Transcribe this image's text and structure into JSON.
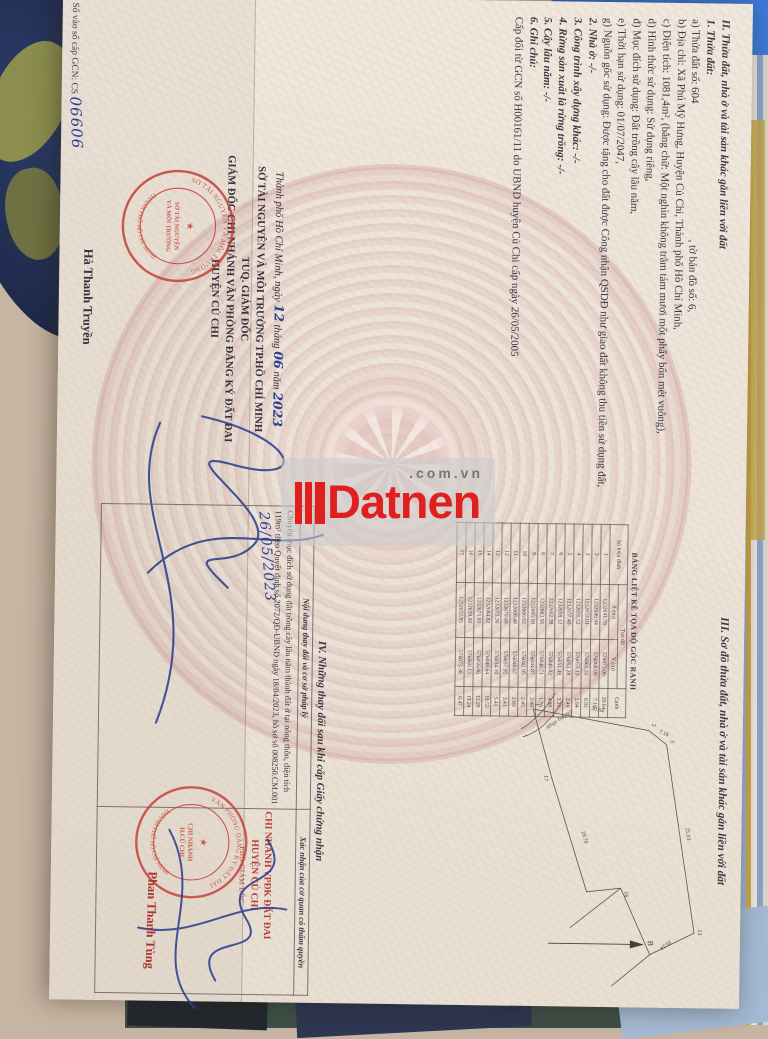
{
  "watermark": {
    "brand": "Datnen",
    "suffix": ".com.vn"
  },
  "page_left": {
    "section2": {
      "lines": [
        {
          "t": "II. Thửa đất, nhà ở và tài sản khác gắn liền với đất",
          "c": "hd"
        },
        {
          "t": "1. Thửa đất:",
          "c": "hd"
        },
        {
          "t": "a) Thửa đất số: 604                                                  , tờ bản đồ số: 6,",
          "c": ""
        },
        {
          "t": "b) Địa chỉ: Xã Phú Mỹ Hưng, Huyện Củ Chi, Thành phố Hồ Chí Minh,",
          "c": ""
        },
        {
          "t": "c) Diện tích: 1081,4m², (bằng chữ: Một nghìn không trăm tám mươi mốt phẩy bốn mét vuông),",
          "c": ""
        },
        {
          "t": "d) Hình thức sử dụng: Sử dụng riêng,",
          "c": ""
        },
        {
          "t": "đ) Mục đích sử dụng: Đất trồng cây lâu năm,",
          "c": ""
        },
        {
          "t": "e) Thời hạn sử dụng: 01/07/2047,",
          "c": ""
        },
        {
          "t": "g) Nguồn gốc sử dụng: Được tặng cho đất được Công nhận QSDĐ như giao đất không thu tiền sử dụng đất,",
          "c": ""
        },
        {
          "t": "2. Nhà ở: -/-",
          "c": "hd"
        },
        {
          "t": "3. Công trình xây dựng khác: -/-",
          "c": "hd"
        },
        {
          "t": "4. Rừng sản xuất là rừng trồng: -/-",
          "c": "hd"
        },
        {
          "t": "5. Cây lâu năm: -/-",
          "c": "hd"
        },
        {
          "t": "6. Ghi chú:",
          "c": "hd"
        },
        {
          "t": "Cấp đổi từ GCN số H00161/11 do UBND huyện Củ Chi cấp ngày 26/05/2005",
          "c": ""
        }
      ]
    },
    "book_no": {
      "label": "Số vào sổ cấp GCN: CS ",
      "value": "06606"
    },
    "sign_block": {
      "place": "Thành phố Hồ Chí Minh, ngày",
      "day": "12",
      "thang": "tháng",
      "month": "06",
      "nam": "năm",
      "year": "2023",
      "org": "SỞ TÀI NGUYÊN VÀ MÔI TRƯỜNG TP.HỒ CHÍ MINH",
      "tuq": "TUQ. GIÁM ĐỐC",
      "director": "GIÁM ĐỐC CHI NHÁNH VĂN PHÒNG ĐĂNG KÝ ĐẤT ĐAI",
      "district": "HUYỆN CỦ CHI",
      "signer": "Hà Thanh Truyền"
    },
    "stamp": {
      "arc_top": "SỞ TÀI NGUYÊN VÀ MÔI TRƯỜNG",
      "arc_bottom": "THÀNH PHỐ HỒ CHÍ MINH",
      "center1": "SỞ TÀI NGUYÊN",
      "center2": "VÀ MÔI TRƯỜNG",
      "star": "★"
    }
  },
  "page_right": {
    "section3_title": "III. Sơ đồ thửa đất, nhà ở và tài sản khác gắn liền với đất",
    "coord_table": {
      "title": "BẢNG LIỆT KÊ TỌA ĐỘ GÓC RANH",
      "col_point": "Số hiệu đỉnh",
      "col_coord": "Tọa độ",
      "col_x": "X (m)",
      "col_y": "Y (m)",
      "col_edge": "Cạnh",
      "rows": [
        [
          "1",
          "1232641.76",
          "576073.00",
          "20.64"
        ],
        [
          "2",
          "1232649.94",
          "576068.09",
          "7.16"
        ],
        [
          "3",
          "1232653.01",
          "576061.31",
          "6.92"
        ],
        [
          "4",
          "1232655.52",
          "576055.13",
          "2.64"
        ],
        [
          "5",
          "1232657.40",
          "576053.28",
          "2.49"
        ],
        [
          "6",
          "1232659.12",
          "576051.49",
          "2.31"
        ],
        [
          "7",
          "1232662.38",
          "576048.02",
          "4.90"
        ],
        [
          "8",
          "1232663.56",
          "576046.71",
          "1.76"
        ],
        [
          "9",
          "1232665.10",
          "576044.87",
          "2.40"
        ],
        [
          "10",
          "1232666.62",
          "576042.95",
          "2.45"
        ],
        [
          "11",
          "1232668.40",
          "576040.67",
          "2.89"
        ],
        [
          "12",
          "1232670.49",
          "576037.92",
          "3.41"
        ],
        [
          "13",
          "1232673.36",
          "576034.10",
          "5.41"
        ],
        [
          "14",
          "1232684.82",
          "576048.64",
          "18.52"
        ],
        [
          "15",
          "1232675.03",
          "576056.06",
          "12.28"
        ],
        [
          "16",
          "1232659.60",
          "576068.13",
          "19.24"
        ],
        [
          "17",
          "1232652.95",
          "576073.38",
          "8.47"
        ]
      ]
    },
    "map": {
      "road_label": "Đường nhựa",
      "north_label": "B",
      "vertices": [
        "1",
        "2",
        "3",
        "13",
        "16",
        "17"
      ],
      "edge_labels": [
        "20.64",
        "7.16",
        "25.03",
        "19.24",
        "20.70"
      ]
    },
    "section4": {
      "title": "IV. Những thay đổi sau khi cấp Giấy chứng nhận",
      "col_content": "Nội dung thay đổi và cơ sở pháp lý",
      "col_confirm": "Xác nhận của cơ quan có thẩm quyền",
      "entry": "Chuyển mục đích sử dụng đất trồng cây lâu năm thành đất ở tại nông thôn, diện tích 119m² theo Quyết định số 2072/QĐ-UBND ngày 18/04/2023, hồ sơ số 008250.CM.001",
      "entry_date": "26/05/2023",
      "office1": "CHI NHÁNH VPĐK ĐẤT ĐAI",
      "office2": "HUYỆN CỦ CHI",
      "deputy": "PHÓ GIÁM ĐỐC",
      "signer": "Phan Thanh Tùng",
      "stamp": {
        "arc_top": "VĂN PHÒNG ĐĂNG KÝ ĐẤT ĐAI",
        "arc_bottom": "THÀNH PHỐ HỒ CHÍ MINH",
        "center1": "CHI NHÁNH",
        "center2": "H.CỦ CHI",
        "star": "★"
      }
    }
  }
}
